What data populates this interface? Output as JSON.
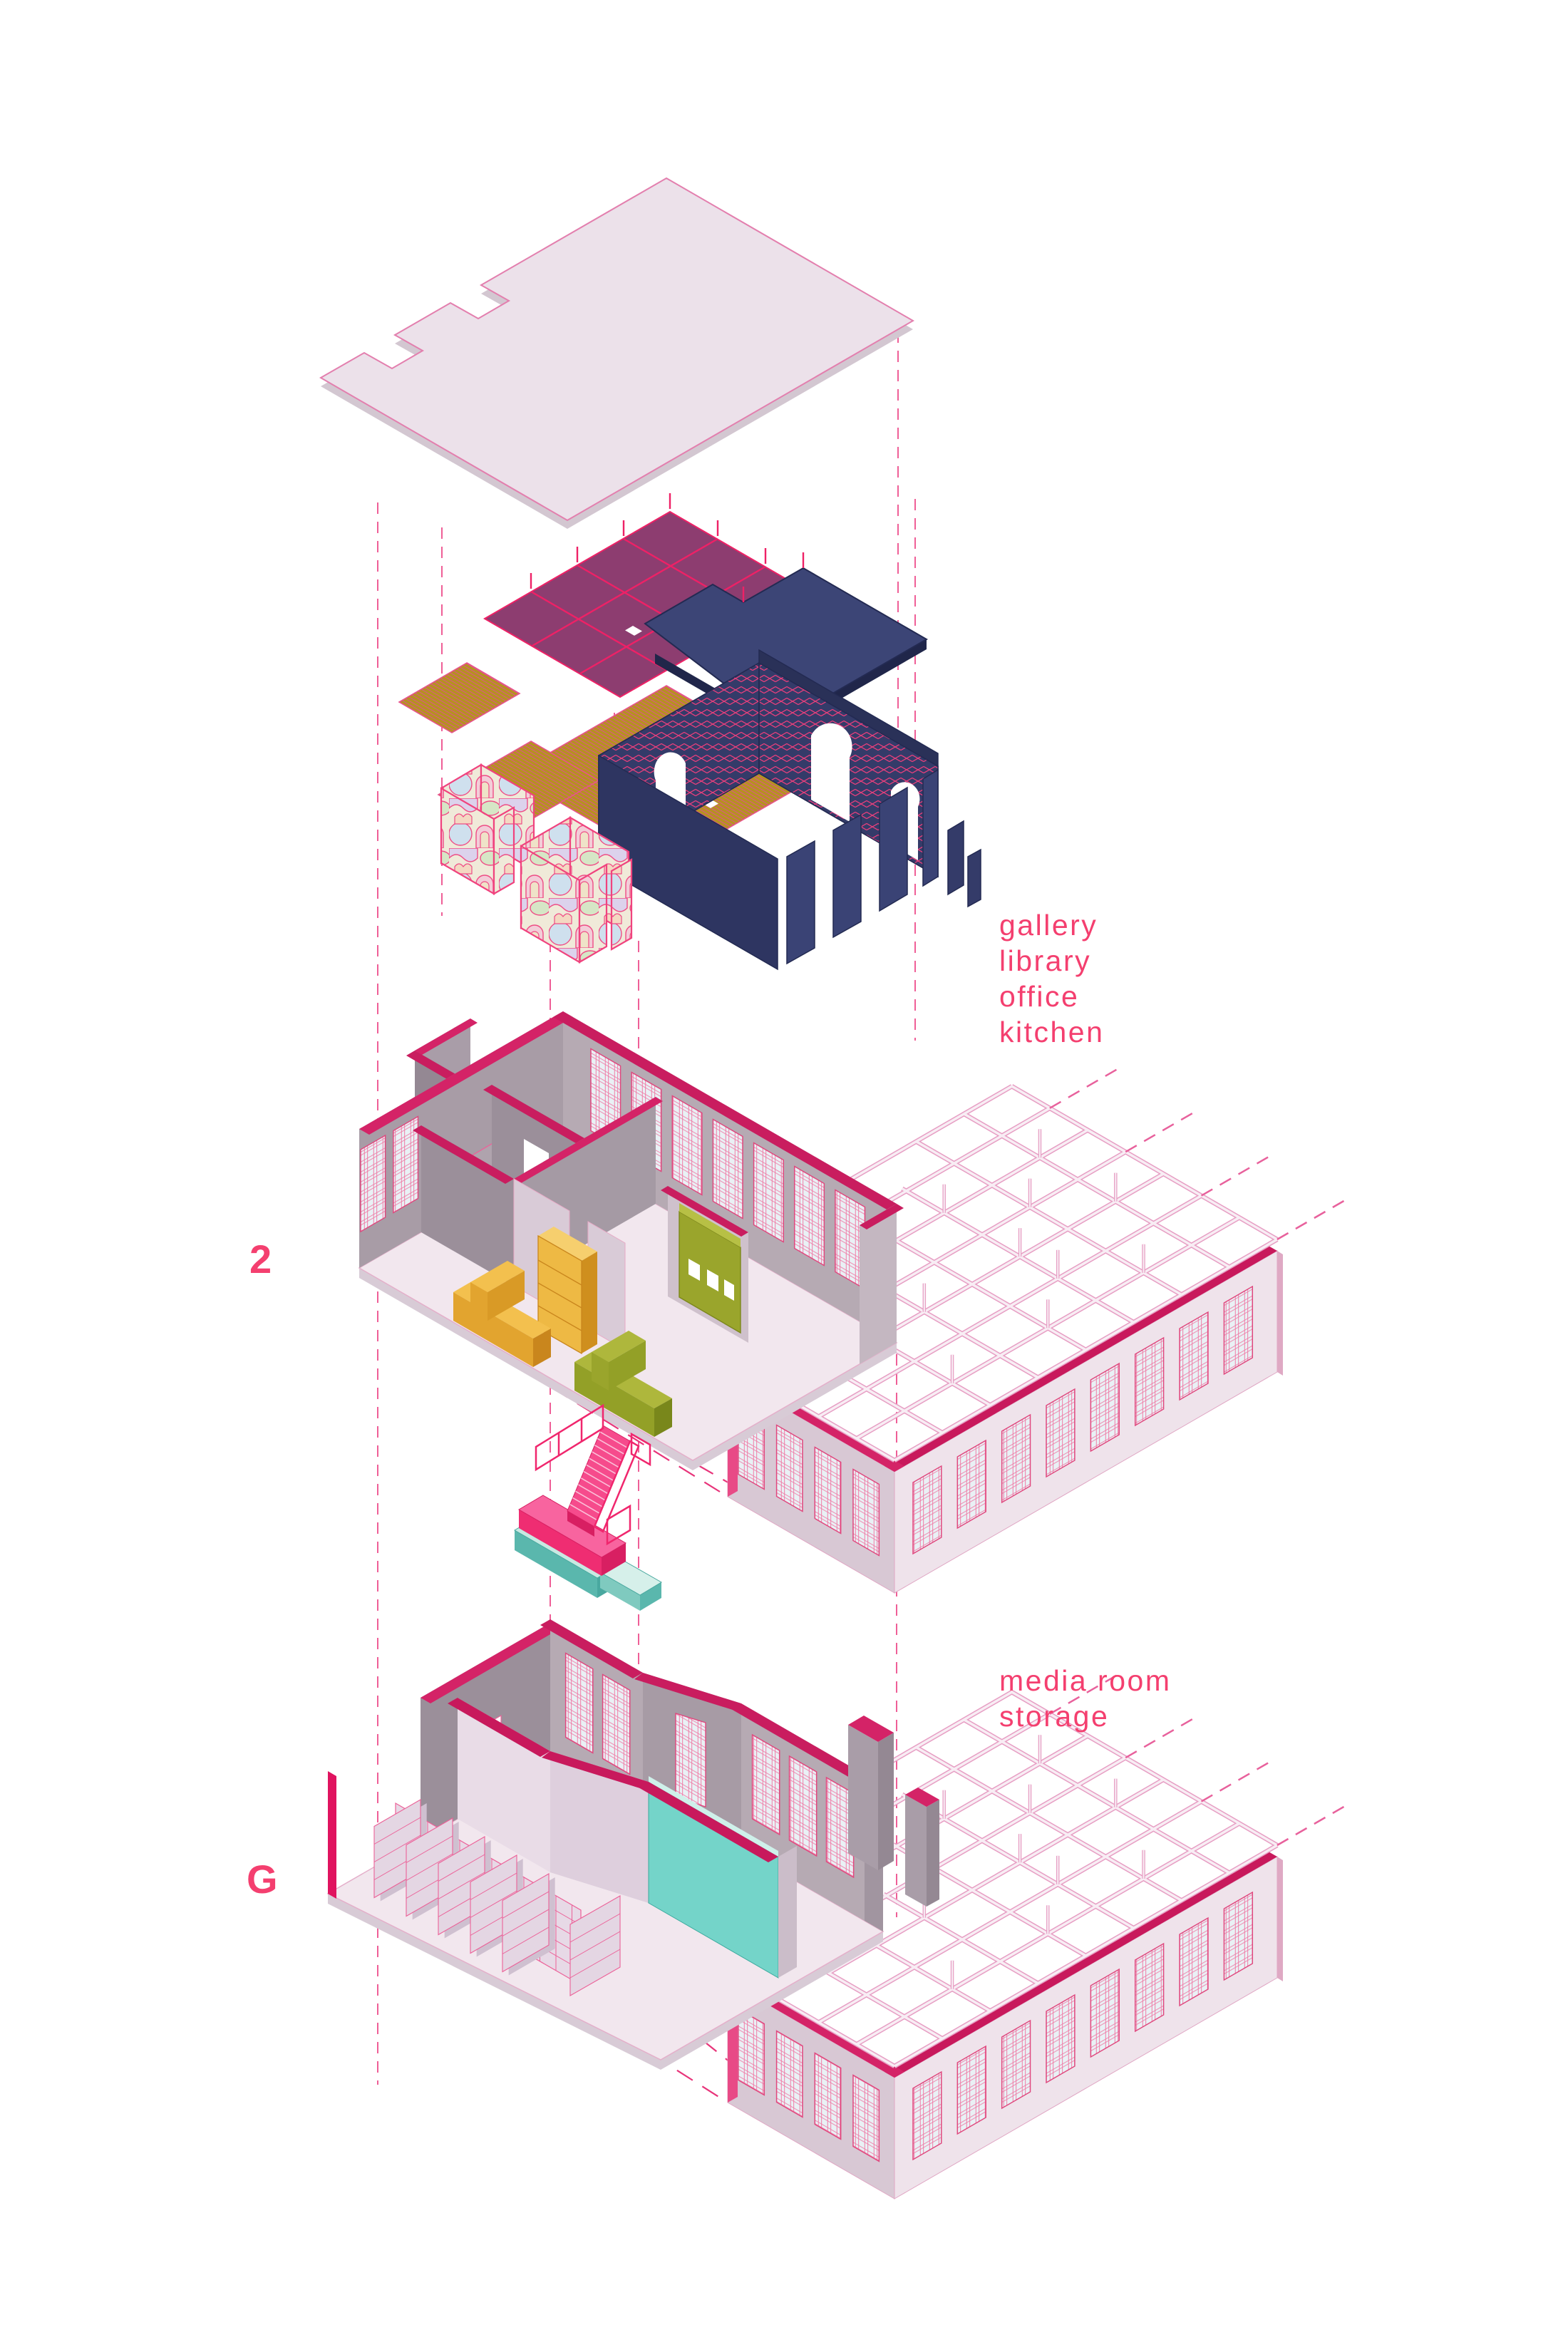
{
  "diagram": {
    "type": "exploded-axonometric",
    "levels": [
      {
        "id": "2",
        "label": "2",
        "programs": [
          "gallery",
          "library",
          "office",
          "kitchen"
        ]
      },
      {
        "id": "G",
        "label": "G",
        "programs": [
          "media room",
          "storage"
        ]
      }
    ]
  },
  "colors": {
    "accent_pink": "#f43f6f",
    "crimson": "#c8195c",
    "magenta_line": "#ee2166",
    "navy": "#2e3561",
    "plum": "#8d3d70",
    "gold": "#b5921f",
    "olive": "#9aa52c",
    "yellow": "#f3c04e",
    "teal": "#74d4c9",
    "lavender_floor": "#f2e7ee",
    "wall_gray": "#b3a7b1",
    "background": "#ffffff"
  }
}
